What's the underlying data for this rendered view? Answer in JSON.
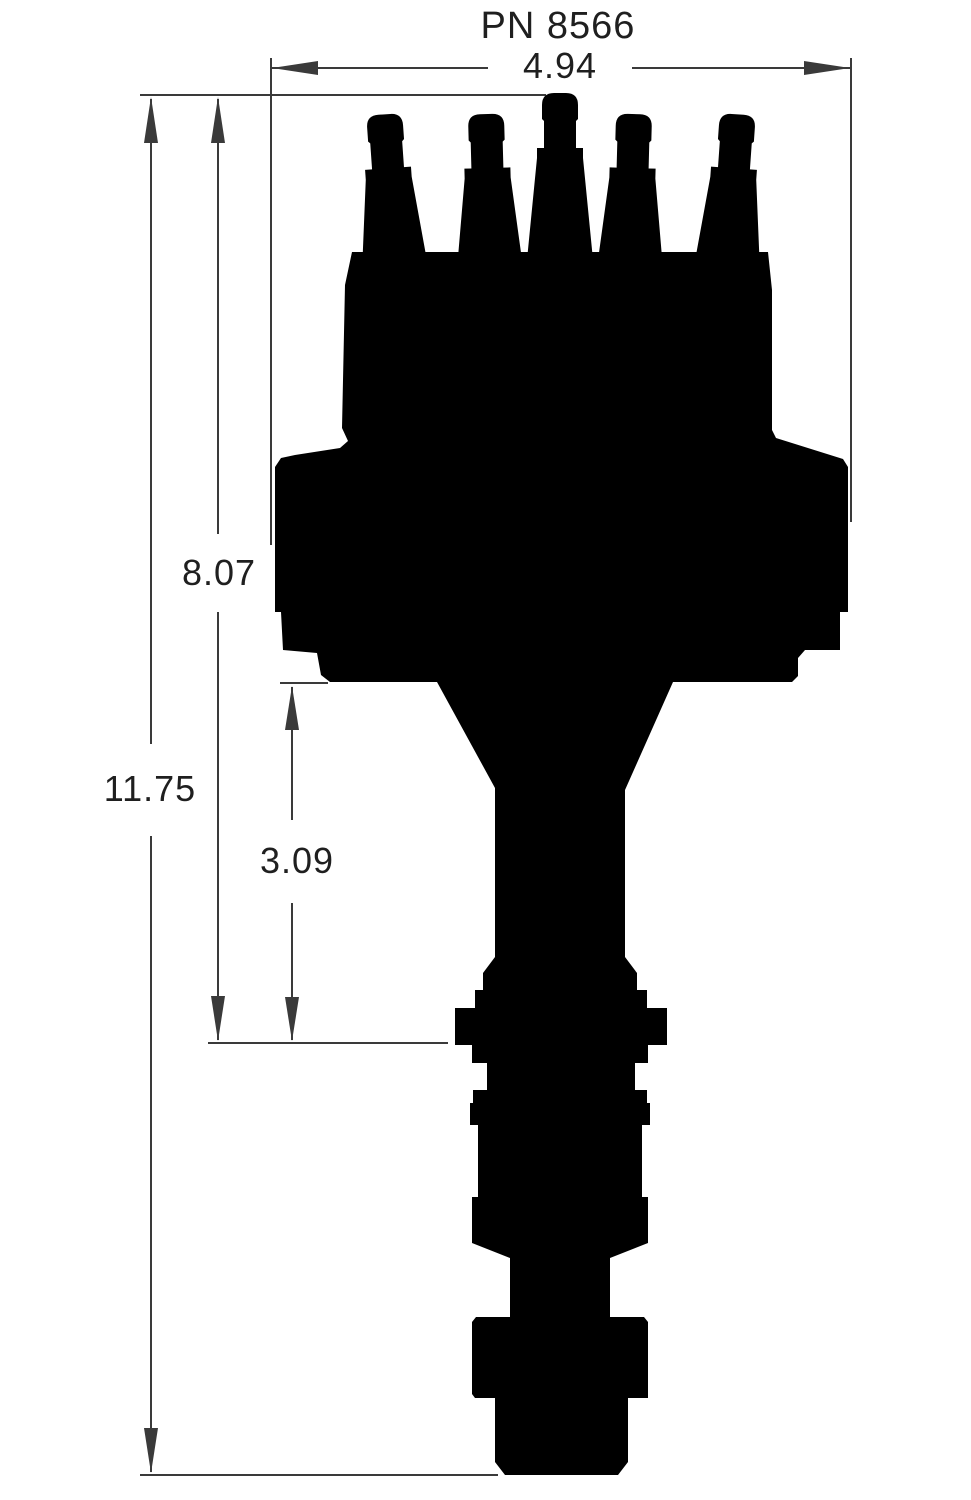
{
  "drawing": {
    "title": "PN 8566",
    "dimensions": [
      {
        "name": "overall-width",
        "value": "4.94"
      },
      {
        "name": "cap-top-to-mounting-flange",
        "value": "8.07"
      },
      {
        "name": "overall-height",
        "value": "11.75"
      },
      {
        "name": "mounting-flange-to-collar",
        "value": "3.09"
      }
    ],
    "colors": {
      "background": "#ffffff",
      "ink": "#000000",
      "line": "#3a3a3a",
      "text": "#1f1f1f"
    }
  }
}
